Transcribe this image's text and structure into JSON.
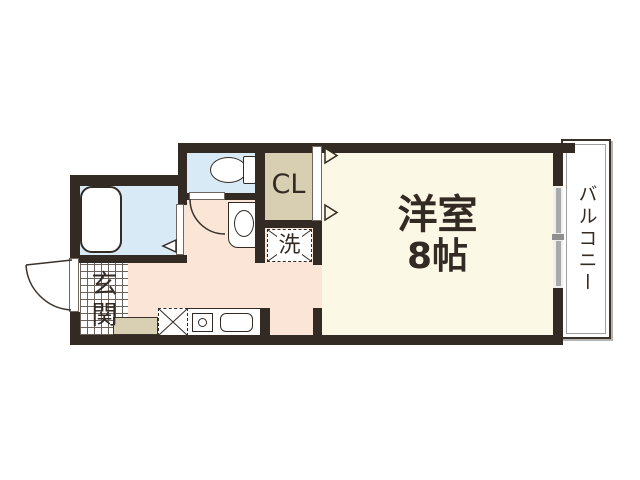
{
  "floorplan": {
    "rooms": {
      "western": {
        "name": "洋室",
        "size": "8帖"
      },
      "closet": {
        "label": "CL"
      },
      "laundry": {
        "label": "洗"
      },
      "entrance": {
        "label": "玄関"
      },
      "balcony": {
        "label": "バルコニー"
      }
    },
    "colors": {
      "wall": "#332a24",
      "western_room_floor": "#fcf8e6",
      "hallway_kitchen_floor": "#fbe5d7",
      "bath_toilet_floor": "#d9eaf7",
      "closet_floor": "#d8cfb3",
      "entrance_tile": "#ffffff",
      "glass_door": "#a9a9a9",
      "background": "#ffffff"
    },
    "fixtures": [
      "bathtub",
      "toilet",
      "vanity-sink",
      "kitchen-counter",
      "stove-burner",
      "kitchen-sink",
      "washer-space",
      "refrigerator-space",
      "shoe-cabinet",
      "sliding-glass-door",
      "closet-sliding-door",
      "entrance-door",
      "toilet-door",
      "bathroom-folding-door"
    ]
  }
}
